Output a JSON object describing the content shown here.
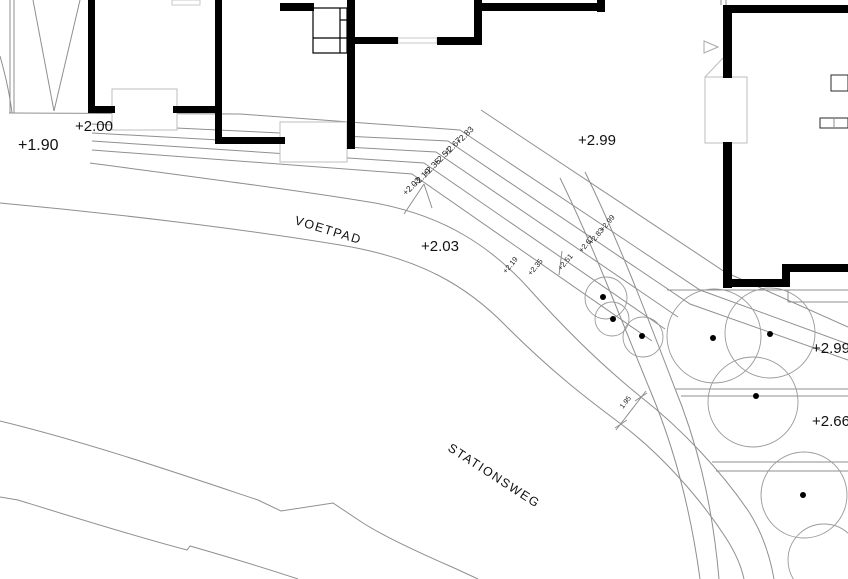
{
  "plan": {
    "streets": [
      {
        "name": "VOETPAD"
      },
      {
        "name": "STATIONSWEG"
      }
    ],
    "spot_elevations": [
      {
        "id": "left-lot",
        "value": "+1.90"
      },
      {
        "id": "entrance-left",
        "value": "+2.00"
      },
      {
        "id": "walkway",
        "value": "+2.03"
      },
      {
        "id": "terrace-upper",
        "value": "+2.99"
      },
      {
        "id": "terrace-right",
        "value": "+2.99"
      },
      {
        "id": "garden-right",
        "value": "+2.66"
      }
    ],
    "steps_flight_upper": [
      "+2.83",
      "+2.67",
      "+2.51",
      "+2.35",
      "+2.19",
      "+2.03"
    ],
    "steps_flight_lower": [
      "+2.19",
      "+2.35",
      "+2.51",
      "+2.67",
      "+2.83",
      "+2.99"
    ],
    "dimension": {
      "value": "1.95"
    },
    "symbols": {
      "tree": "circle-with-center-dot",
      "door": "triangle-marker"
    },
    "colors": {
      "wall": "#000000",
      "line": "#8f8f8f",
      "light_line": "#bdbdbd",
      "text": "#111111",
      "background": "#ffffff"
    }
  }
}
